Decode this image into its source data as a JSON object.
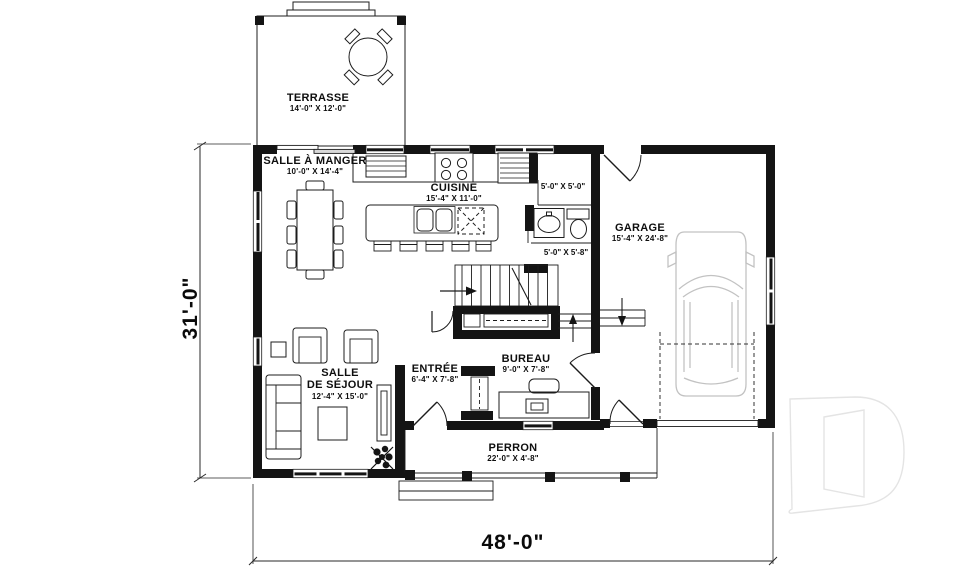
{
  "plan_title": "floor-plan",
  "colors": {
    "background": "#ffffff",
    "ink": "#141414",
    "thin_line": "#222222",
    "car_outline": "#c2c2c2",
    "watermark_stroke": "#e4e4e4"
  },
  "rooms": {
    "terrasse": {
      "name": "TERRASSE",
      "dims": "14'-0\" X 12'-0\""
    },
    "salle_a_manger": {
      "name": "SALLE À MANGER",
      "dims": "10'-0\" X 14'-4\""
    },
    "cuisine": {
      "name": "CUISINE",
      "dims": "15'-4\" X 11'-0\""
    },
    "garde_manger": {
      "dims": "5'-0\" X 5'-0\""
    },
    "salle_eau": {
      "dims": "5'-0\" X 5'-8\""
    },
    "garage": {
      "name": "GARAGE",
      "dims": "15'-4\" X 24'-8\""
    },
    "salle_de_sejour": {
      "name_line1": "SALLE",
      "name_line2": "DE SÉJOUR",
      "dims": "12'-4\" X 15'-0\""
    },
    "entree": {
      "name": "ENTRÉE",
      "dims": "6'-4\" X 7'-8\""
    },
    "bureau": {
      "name": "BUREAU",
      "dims": "9'-0\" X 7'-8\""
    },
    "perron": {
      "name": "PERRON",
      "dims": "22'-0\" X 4'-8\""
    }
  },
  "dimensions": {
    "overall_width": "48'-0\"",
    "overall_depth": "31'-0\""
  }
}
